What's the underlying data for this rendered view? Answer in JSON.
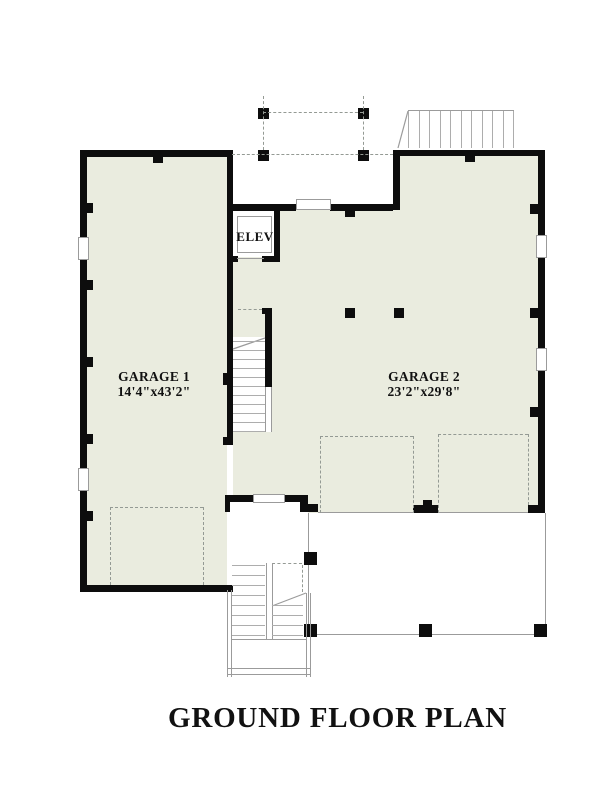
{
  "title": "GROUND FLOOR PLAN",
  "labels": {
    "garage1": {
      "name": "GARAGE 1",
      "dims": "14'4\"x43'2\""
    },
    "garage2": {
      "name": "GARAGE 2",
      "dims": "23'2\"x29'8\""
    },
    "elevator": "ELEV"
  },
  "colors": {
    "wall": "#0d0d0d",
    "floor_fill": "#eaecdf",
    "thin_line": "#9b9b9b",
    "background": "#ffffff",
    "text": "#111111"
  }
}
